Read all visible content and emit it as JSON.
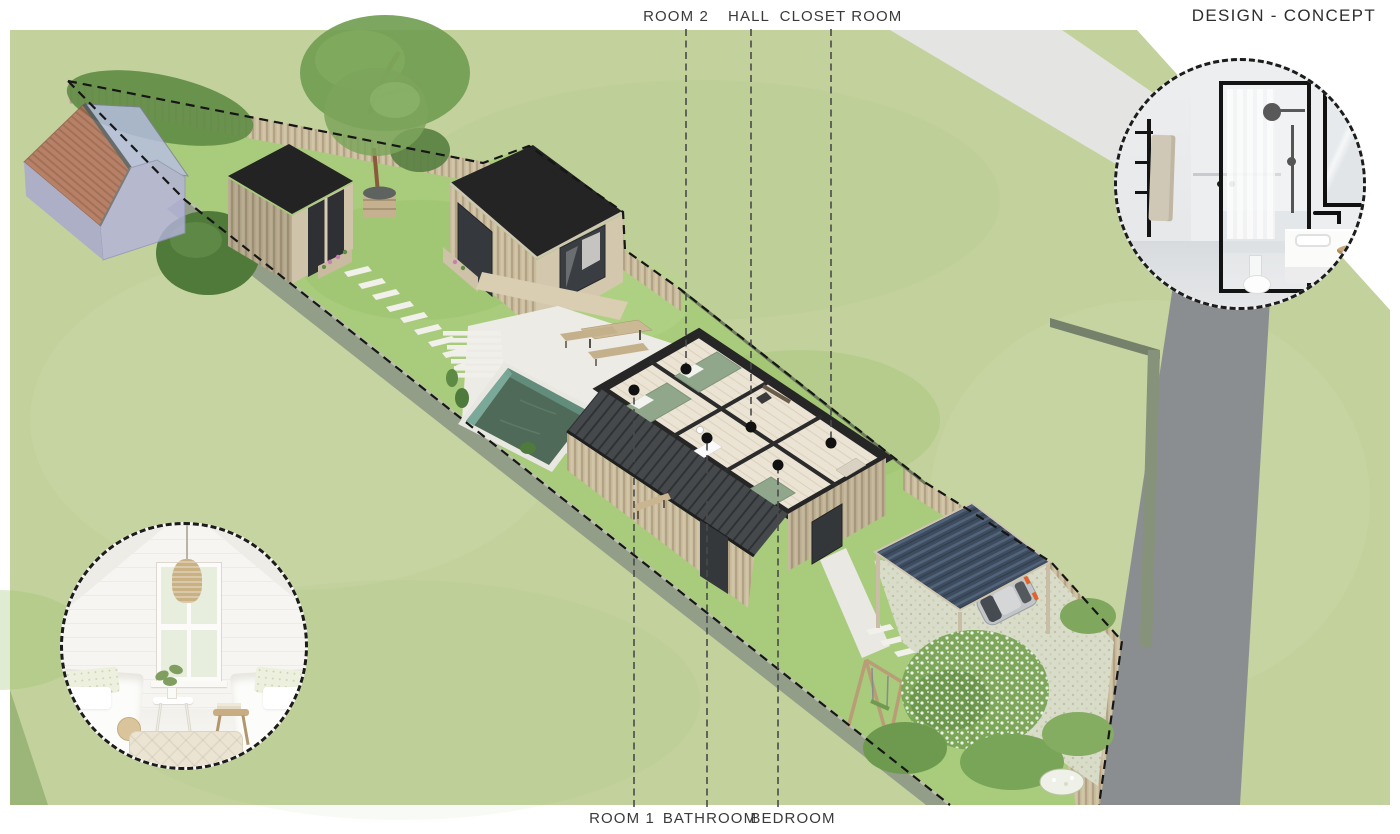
{
  "title": "DESIGN - CONCEPT",
  "callouts": {
    "top": [
      {
        "label": "ROOM 2",
        "label_x": 676,
        "line_x": 686,
        "dot_x": 686,
        "dot_y": 369
      },
      {
        "label": "HALL",
        "label_x": 749,
        "line_x": 751,
        "dot_x": 751,
        "dot_y": 427
      },
      {
        "label": "CLOSET ROOM",
        "label_x": 841,
        "line_x": 831,
        "dot_x": 831,
        "dot_y": 443
      }
    ],
    "bottom": [
      {
        "label": "ROOM 1",
        "label_x": 622,
        "line_x": 634,
        "dot_x": 634,
        "dot_y": 390
      },
      {
        "label": "BATHROOM",
        "label_x": 710,
        "line_x": 707,
        "dot_x": 707,
        "dot_y": 438
      },
      {
        "label": "BEDROOM",
        "label_x": 793,
        "line_x": 778,
        "dot_x": 778,
        "dot_y": 465
      }
    ]
  },
  "scene": {
    "objects": [
      "neighbor-barn",
      "garden-shed",
      "garden-studio",
      "stepping-path",
      "terrace",
      "pool",
      "picnic-table",
      "main-house-cutaway",
      "carport",
      "car",
      "swing-set",
      "flowering-tree",
      "wooden-fence",
      "concrete-wall",
      "road",
      "driveway-band",
      "property-boundary"
    ],
    "palette": {
      "grass_outer": "#c3d29c",
      "grass_plot": "#a8cb7c",
      "road": "#8b8e91",
      "driveway_band": "#e4e5e2",
      "fence_wood": "#cbbd9f",
      "concrete_wall": "#939e89",
      "roof_black": "#242424",
      "house_roof": "#46494c",
      "carport_roof": "#3d4c5e",
      "pool_water": "#4f6a59",
      "terrace": "#ecebe5",
      "barn_wall": "#b4b3da",
      "barn_roof": "#b5705c",
      "bed_green": "#91a78c",
      "boundary_line": "#161616",
      "label_text": "#3a3a3a"
    }
  },
  "insets": {
    "bathroom": {
      "name": "bathroom-concept-photo"
    },
    "bedroom": {
      "name": "bedroom-concept-photo"
    }
  }
}
